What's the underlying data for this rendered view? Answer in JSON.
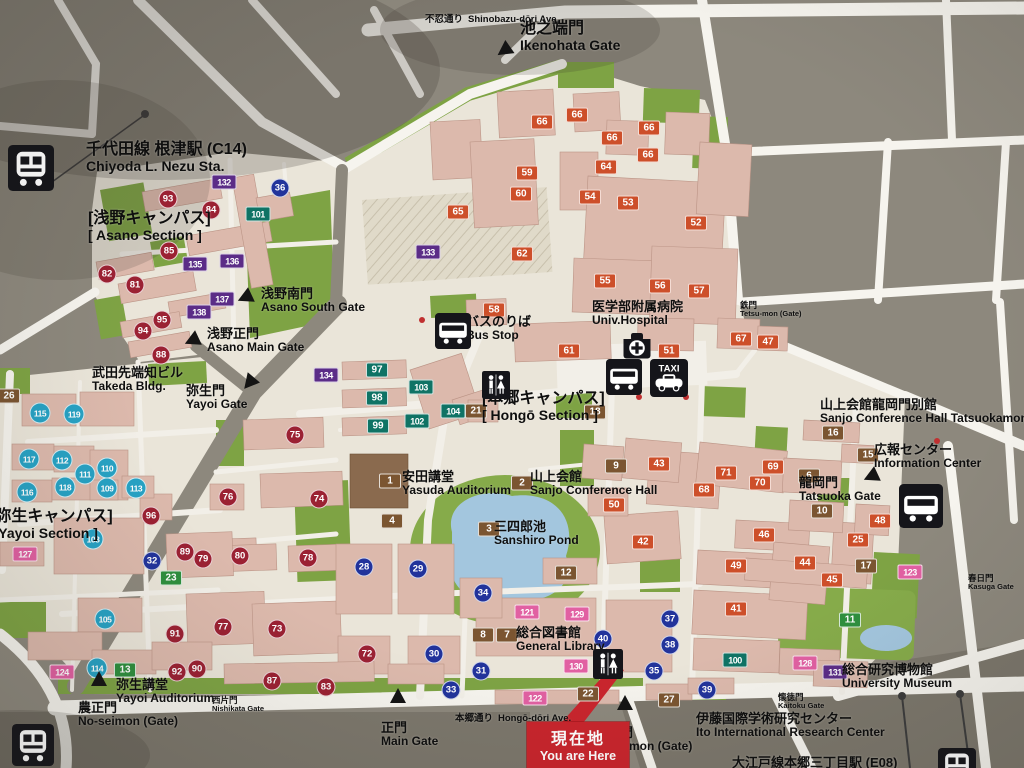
{
  "map_title": "University of Tokyo Hongo Campus Guide Map",
  "you_are_here": {
    "jp": "現在地",
    "en": "You are Here"
  },
  "colors": {
    "badge": {
      "red": "#9b2133",
      "blue": "#22339b",
      "cyan": "#27a2c4",
      "brown": "#7b5531",
      "orange": "#cd4f2a",
      "teal": "#0f7365",
      "green": "#2e8f3e",
      "purple": "#5b2c87",
      "pink": "#e160a2"
    },
    "you_are_here_red": "#c9252d",
    "campus": "#eae5d9",
    "outside": "#8d887d",
    "green_area": "#7ea344",
    "pond": "#a3c6de",
    "building": "#dcb9ac",
    "road": "#f6f4ee"
  },
  "labels": [
    {
      "id": "nezu-station",
      "jp": "千代田線 根津駅 (C14)",
      "en": "Chiyoda L. Nezu Sta.",
      "x": 86,
      "y": 141,
      "size": "lg"
    },
    {
      "id": "shinobazu-ave",
      "jp": "不忍通り",
      "en": "Shinobazu-dōri Ave.",
      "x": 425,
      "y": 9,
      "size": "inline"
    },
    {
      "id": "ikenohata-gate",
      "jp": "池之端門",
      "en": "Ikenohata Gate",
      "x": 520,
      "y": 20,
      "size": "lg"
    },
    {
      "id": "asano-section",
      "jp": "[浅野キャンパス]",
      "en": "[ Asano Section ]",
      "x": 88,
      "y": 210,
      "size": "lg"
    },
    {
      "id": "asano-south-gate",
      "jp": "浅野南門",
      "en": "Asano South Gate",
      "x": 261,
      "y": 287,
      "size": "md"
    },
    {
      "id": "asano-main-gate",
      "jp": "浅野正門",
      "en": "Asano Main Gate",
      "x": 207,
      "y": 327,
      "size": "md"
    },
    {
      "id": "takeda-bldg",
      "jp": "武田先端知ビル",
      "en": "Takeda Bldg.",
      "x": 92,
      "y": 366,
      "size": "md"
    },
    {
      "id": "yayoi-gate",
      "jp": "弥生門",
      "en": "Yayoi Gate",
      "x": 186,
      "y": 384,
      "size": "md"
    },
    {
      "id": "bus-stop",
      "jp": "バスのりば",
      "en": "Bus Stop",
      "x": 466,
      "y": 315,
      "size": "md"
    },
    {
      "id": "univ-hospital",
      "jp": "医学部附属病院",
      "en": "Univ.Hospital",
      "x": 592,
      "y": 300,
      "size": "md"
    },
    {
      "id": "hongo-section",
      "jp": "[本郷キャンパス]",
      "en": "[ Hongō Section ]",
      "x": 482,
      "y": 390,
      "size": "lg"
    },
    {
      "id": "sanjo-tatsuokamon",
      "jp": "山上会館龍岡門別館",
      "en": "Sanjo Conference Hall Tatsuokamon",
      "x": 820,
      "y": 398,
      "size": "md"
    },
    {
      "id": "info-center",
      "jp": "広報センター",
      "en": "Information Center",
      "x": 874,
      "y": 443,
      "size": "md"
    },
    {
      "id": "tatsuoka-gate",
      "jp": "龍岡門",
      "en": "Tatsuoka Gate",
      "x": 799,
      "y": 476,
      "size": "md"
    },
    {
      "id": "tetsu-mon",
      "jp": "鉄門",
      "en": "Tetsu-mon (Gate)",
      "x": 740,
      "y": 301,
      "size": "xs"
    },
    {
      "id": "yasuda-auditorium",
      "jp": "安田講堂",
      "en": "Yasuda Auditorium",
      "x": 402,
      "y": 470,
      "size": "md"
    },
    {
      "id": "sanjo-hall",
      "jp": "山上会館",
      "en": "Sanjo Conference Hall",
      "x": 530,
      "y": 470,
      "size": "md"
    },
    {
      "id": "sanshiro-pond",
      "jp": "三四郎池",
      "en": "Sanshiro Pond",
      "x": 494,
      "y": 520,
      "size": "md"
    },
    {
      "id": "general-library",
      "jp": "総合図書館",
      "en": "General Library",
      "x": 516,
      "y": 626,
      "size": "md"
    },
    {
      "id": "yayoi-section",
      "jp": "[弥生キャンパス]",
      "en": "[ Yayoi Section ]",
      "x": -10,
      "y": 508,
      "size": "lg"
    },
    {
      "id": "yayoi-auditorium",
      "jp": "弥生講堂",
      "en": "Yayoi Auditorium",
      "x": 116,
      "y": 678,
      "size": "md"
    },
    {
      "id": "nishikata-gate",
      "jp": "西片門",
      "en": "Nishikata Gate",
      "x": 212,
      "y": 696,
      "size": "xs"
    },
    {
      "id": "no-seimon",
      "jp": "農正門",
      "en": "No-seimon (Gate)",
      "x": 78,
      "y": 701,
      "size": "md"
    },
    {
      "id": "main-gate",
      "jp": "正門",
      "en": "Main Gate",
      "x": 381,
      "y": 721,
      "size": "md"
    },
    {
      "id": "hongo-ave",
      "jp": "本郷通り",
      "en": "Hongō-dōri Ave.",
      "x": 455,
      "y": 708,
      "size": "inline"
    },
    {
      "id": "akamon",
      "jp": "赤門",
      "en": "Akamon (Gate)",
      "x": 607,
      "y": 726,
      "size": "md"
    },
    {
      "id": "ito-center",
      "jp": "伊藤国際学術研究センター",
      "en": "Ito International Research Center",
      "x": 696,
      "y": 712,
      "size": "md"
    },
    {
      "id": "university-museum",
      "jp": "総合研究博物館",
      "en": "University Museum",
      "x": 842,
      "y": 663,
      "size": "md"
    },
    {
      "id": "kaitoku-gate",
      "jp": "懐徳門",
      "en": "Kaitoku Gate",
      "x": 778,
      "y": 693,
      "size": "xs"
    },
    {
      "id": "kasuga-gate",
      "jp": "春日門",
      "en": "Kasuga Gate",
      "x": 968,
      "y": 574,
      "size": "xs"
    },
    {
      "id": "oedo-station",
      "jp": "大江戸線本郷三丁目駅 (E08)",
      "en": "",
      "x": 732,
      "y": 756,
      "size": "md"
    }
  ],
  "gate_markers": [
    {
      "id": "ikenohata",
      "x": 505,
      "y": 50,
      "rot": -125
    },
    {
      "id": "asano-south",
      "x": 246,
      "y": 297,
      "rot": -115
    },
    {
      "id": "asano-main",
      "x": 193,
      "y": 340,
      "rot": -115
    },
    {
      "id": "yayoi",
      "x": 250,
      "y": 382,
      "rot": -140
    },
    {
      "id": "tatsuoka",
      "x": 872,
      "y": 476,
      "rot": -115
    },
    {
      "id": "no-seimon",
      "x": 99,
      "y": 680,
      "rot": 0
    },
    {
      "id": "main",
      "x": 398,
      "y": 697,
      "rot": 0
    },
    {
      "id": "akamon",
      "x": 625,
      "y": 704,
      "rot": 0
    }
  ],
  "icons": [
    {
      "name": "train-icon",
      "x": 8,
      "y": 145,
      "s": 46
    },
    {
      "name": "train-icon",
      "x": 12,
      "y": 724,
      "s": 42
    },
    {
      "name": "train-icon",
      "x": 938,
      "y": 748,
      "s": 38
    },
    {
      "name": "bus-stop-icon",
      "x": 435,
      "y": 313,
      "s": 36
    },
    {
      "name": "hospital-icon",
      "x": 619,
      "y": 327,
      "s": 36
    },
    {
      "name": "bus-icon",
      "x": 606,
      "y": 359,
      "s": 36
    },
    {
      "name": "taxi-icon",
      "x": 650,
      "y": 359,
      "s": 38,
      "label": "TAXI"
    },
    {
      "name": "restroom-icon",
      "x": 482,
      "y": 371,
      "s": 28
    },
    {
      "name": "restroom-icon",
      "x": 593,
      "y": 649,
      "s": 30
    },
    {
      "name": "bus-icon",
      "x": 899,
      "y": 484,
      "s": 44
    }
  ],
  "badges": [
    {
      "n": "1",
      "t": "brown",
      "x": 390,
      "y": 481
    },
    {
      "n": "2",
      "t": "brown",
      "x": 522,
      "y": 483
    },
    {
      "n": "3",
      "t": "brown",
      "x": 489,
      "y": 529
    },
    {
      "n": "4",
      "t": "brown",
      "x": 392,
      "y": 521
    },
    {
      "n": "6",
      "t": "brown",
      "x": 809,
      "y": 476
    },
    {
      "n": "7",
      "t": "brown",
      "x": 507,
      "y": 635
    },
    {
      "n": "8",
      "t": "brown",
      "x": 483,
      "y": 635
    },
    {
      "n": "9",
      "t": "brown",
      "x": 616,
      "y": 466
    },
    {
      "n": "10",
      "t": "brown",
      "x": 822,
      "y": 511
    },
    {
      "n": "12",
      "t": "brown",
      "x": 566,
      "y": 573
    },
    {
      "n": "15",
      "t": "brown",
      "x": 868,
      "y": 455
    },
    {
      "n": "16",
      "t": "brown",
      "x": 833,
      "y": 433
    },
    {
      "n": "17",
      "t": "brown",
      "x": 866,
      "y": 566
    },
    {
      "n": "18",
      "t": "brown",
      "x": 595,
      "y": 412
    },
    {
      "n": "21",
      "t": "brown",
      "x": 476,
      "y": 411
    },
    {
      "n": "22",
      "t": "brown",
      "x": 588,
      "y": 694
    },
    {
      "n": "26",
      "t": "brown",
      "x": 9,
      "y": 396
    },
    {
      "n": "27",
      "t": "brown",
      "x": 669,
      "y": 700
    },
    {
      "n": "11",
      "t": "green",
      "x": 850,
      "y": 620
    },
    {
      "n": "13",
      "t": "green",
      "x": 125,
      "y": 670
    },
    {
      "n": "23",
      "t": "green",
      "x": 171,
      "y": 578
    },
    {
      "n": "25",
      "t": "orange",
      "x": 858,
      "y": 540
    },
    {
      "n": "41",
      "t": "orange",
      "x": 736,
      "y": 609
    },
    {
      "n": "42",
      "t": "orange",
      "x": 643,
      "y": 542
    },
    {
      "n": "43",
      "t": "orange",
      "x": 659,
      "y": 464
    },
    {
      "n": "44",
      "t": "orange",
      "x": 805,
      "y": 563
    },
    {
      "n": "45",
      "t": "orange",
      "x": 832,
      "y": 580
    },
    {
      "n": "46",
      "t": "orange",
      "x": 764,
      "y": 535
    },
    {
      "n": "47",
      "t": "orange",
      "x": 768,
      "y": 342
    },
    {
      "n": "48",
      "t": "orange",
      "x": 880,
      "y": 521
    },
    {
      "n": "49",
      "t": "orange",
      "x": 736,
      "y": 566
    },
    {
      "n": "50",
      "t": "orange",
      "x": 614,
      "y": 505
    },
    {
      "n": "51",
      "t": "orange",
      "x": 669,
      "y": 351
    },
    {
      "n": "52",
      "t": "orange",
      "x": 696,
      "y": 223
    },
    {
      "n": "53",
      "t": "orange",
      "x": 628,
      "y": 203
    },
    {
      "n": "54",
      "t": "orange",
      "x": 590,
      "y": 197
    },
    {
      "n": "55",
      "t": "orange",
      "x": 605,
      "y": 281
    },
    {
      "n": "56",
      "t": "orange",
      "x": 660,
      "y": 286
    },
    {
      "n": "57",
      "t": "orange",
      "x": 699,
      "y": 291
    },
    {
      "n": "58",
      "t": "orange",
      "x": 494,
      "y": 310
    },
    {
      "n": "59",
      "t": "orange",
      "x": 527,
      "y": 173
    },
    {
      "n": "60",
      "t": "orange",
      "x": 521,
      "y": 194
    },
    {
      "n": "61",
      "t": "orange",
      "x": 569,
      "y": 351
    },
    {
      "n": "62",
      "t": "orange",
      "x": 522,
      "y": 254
    },
    {
      "n": "64",
      "t": "orange",
      "x": 606,
      "y": 167
    },
    {
      "n": "65",
      "t": "orange",
      "x": 458,
      "y": 212
    },
    {
      "n": "66",
      "t": "orange",
      "x": 542,
      "y": 122
    },
    {
      "n": "66",
      "t": "orange",
      "x": 577,
      "y": 115
    },
    {
      "n": "66",
      "t": "orange",
      "x": 649,
      "y": 128
    },
    {
      "n": "66",
      "t": "orange",
      "x": 612,
      "y": 138
    },
    {
      "n": "66",
      "t": "orange",
      "x": 648,
      "y": 155
    },
    {
      "n": "67",
      "t": "orange",
      "x": 741,
      "y": 339
    },
    {
      "n": "68",
      "t": "orange",
      "x": 704,
      "y": 490
    },
    {
      "n": "69",
      "t": "orange",
      "x": 773,
      "y": 467
    },
    {
      "n": "70",
      "t": "orange",
      "x": 760,
      "y": 483
    },
    {
      "n": "71",
      "t": "orange",
      "x": 726,
      "y": 473
    },
    {
      "n": "72",
      "t": "red",
      "x": 367,
      "y": 654
    },
    {
      "n": "73",
      "t": "red",
      "x": 277,
      "y": 629
    },
    {
      "n": "74",
      "t": "red",
      "x": 319,
      "y": 499
    },
    {
      "n": "75",
      "t": "red",
      "x": 295,
      "y": 435
    },
    {
      "n": "76",
      "t": "red",
      "x": 228,
      "y": 497
    },
    {
      "n": "77",
      "t": "red",
      "x": 223,
      "y": 627
    },
    {
      "n": "78",
      "t": "red",
      "x": 308,
      "y": 558
    },
    {
      "n": "79",
      "t": "red",
      "x": 203,
      "y": 559
    },
    {
      "n": "80",
      "t": "red",
      "x": 240,
      "y": 556
    },
    {
      "n": "81",
      "t": "red",
      "x": 135,
      "y": 285
    },
    {
      "n": "82",
      "t": "red",
      "x": 107,
      "y": 274
    },
    {
      "n": "83",
      "t": "red",
      "x": 326,
      "y": 687
    },
    {
      "n": "84",
      "t": "red",
      "x": 211,
      "y": 210
    },
    {
      "n": "85",
      "t": "red",
      "x": 169,
      "y": 251
    },
    {
      "n": "87",
      "t": "red",
      "x": 272,
      "y": 681
    },
    {
      "n": "88",
      "t": "red",
      "x": 161,
      "y": 355
    },
    {
      "n": "89",
      "t": "red",
      "x": 185,
      "y": 552
    },
    {
      "n": "90",
      "t": "red",
      "x": 197,
      "y": 669
    },
    {
      "n": "91",
      "t": "red",
      "x": 175,
      "y": 634
    },
    {
      "n": "92",
      "t": "red",
      "x": 177,
      "y": 672
    },
    {
      "n": "93",
      "t": "red",
      "x": 168,
      "y": 199
    },
    {
      "n": "94",
      "t": "red",
      "x": 143,
      "y": 331
    },
    {
      "n": "95",
      "t": "red",
      "x": 162,
      "y": 320
    },
    {
      "n": "96",
      "t": "red",
      "x": 151,
      "y": 516
    },
    {
      "n": "28",
      "t": "blue",
      "x": 364,
      "y": 567
    },
    {
      "n": "29",
      "t": "blue",
      "x": 418,
      "y": 569
    },
    {
      "n": "30",
      "t": "blue",
      "x": 434,
      "y": 654
    },
    {
      "n": "31",
      "t": "blue",
      "x": 481,
      "y": 671
    },
    {
      "n": "32",
      "t": "blue",
      "x": 152,
      "y": 561
    },
    {
      "n": "33",
      "t": "blue",
      "x": 451,
      "y": 690
    },
    {
      "n": "34",
      "t": "blue",
      "x": 483,
      "y": 593
    },
    {
      "n": "35",
      "t": "blue",
      "x": 654,
      "y": 671
    },
    {
      "n": "36",
      "t": "blue",
      "x": 280,
      "y": 188
    },
    {
      "n": "37",
      "t": "blue",
      "x": 670,
      "y": 619
    },
    {
      "n": "38",
      "t": "blue",
      "x": 670,
      "y": 645
    },
    {
      "n": "39",
      "t": "blue",
      "x": 707,
      "y": 690
    },
    {
      "n": "40",
      "t": "blue",
      "x": 603,
      "y": 639
    },
    {
      "n": "105",
      "t": "cyan",
      "x": 105,
      "y": 619
    },
    {
      "n": "108",
      "t": "cyan",
      "x": 93,
      "y": 539
    },
    {
      "n": "109",
      "t": "cyan",
      "x": 107,
      "y": 488
    },
    {
      "n": "110",
      "t": "cyan",
      "x": 107,
      "y": 468
    },
    {
      "n": "111",
      "t": "cyan",
      "x": 85,
      "y": 474
    },
    {
      "n": "112",
      "t": "cyan",
      "x": 62,
      "y": 460
    },
    {
      "n": "113",
      "t": "cyan",
      "x": 136,
      "y": 488
    },
    {
      "n": "114",
      "t": "cyan",
      "x": 97,
      "y": 668
    },
    {
      "n": "115",
      "t": "cyan",
      "x": 40,
      "y": 413
    },
    {
      "n": "116",
      "t": "cyan",
      "x": 27,
      "y": 492
    },
    {
      "n": "117",
      "t": "cyan",
      "x": 29,
      "y": 459
    },
    {
      "n": "118",
      "t": "cyan",
      "x": 65,
      "y": 487
    },
    {
      "n": "119",
      "t": "cyan",
      "x": 74,
      "y": 414
    },
    {
      "n": "97",
      "t": "teal",
      "x": 377,
      "y": 370
    },
    {
      "n": "98",
      "t": "teal",
      "x": 377,
      "y": 398
    },
    {
      "n": "99",
      "t": "teal",
      "x": 378,
      "y": 426
    },
    {
      "n": "100",
      "t": "teal",
      "x": 735,
      "y": 660
    },
    {
      "n": "101",
      "t": "teal",
      "x": 258,
      "y": 214
    },
    {
      "n": "102",
      "t": "teal",
      "x": 417,
      "y": 421
    },
    {
      "n": "103",
      "t": "teal",
      "x": 421,
      "y": 387
    },
    {
      "n": "104",
      "t": "teal",
      "x": 453,
      "y": 411
    },
    {
      "n": "131",
      "t": "purple",
      "x": 835,
      "y": 672
    },
    {
      "n": "132",
      "t": "purple",
      "x": 224,
      "y": 182
    },
    {
      "n": "133",
      "t": "purple",
      "x": 428,
      "y": 252
    },
    {
      "n": "134",
      "t": "purple",
      "x": 326,
      "y": 375
    },
    {
      "n": "135",
      "t": "purple",
      "x": 195,
      "y": 264
    },
    {
      "n": "136",
      "t": "purple",
      "x": 232,
      "y": 261
    },
    {
      "n": "137",
      "t": "purple",
      "x": 222,
      "y": 299
    },
    {
      "n": "138",
      "t": "purple",
      "x": 199,
      "y": 312
    },
    {
      "n": "121",
      "t": "pink",
      "x": 527,
      "y": 612
    },
    {
      "n": "122",
      "t": "pink",
      "x": 535,
      "y": 698
    },
    {
      "n": "123",
      "t": "pink",
      "x": 910,
      "y": 572
    },
    {
      "n": "124",
      "t": "pink",
      "x": 62,
      "y": 672
    },
    {
      "n": "127",
      "t": "pink",
      "x": 25,
      "y": 554
    },
    {
      "n": "128",
      "t": "pink",
      "x": 805,
      "y": 663
    },
    {
      "n": "129",
      "t": "pink",
      "x": 577,
      "y": 614
    },
    {
      "n": "130",
      "t": "pink",
      "x": 576,
      "y": 666
    }
  ]
}
